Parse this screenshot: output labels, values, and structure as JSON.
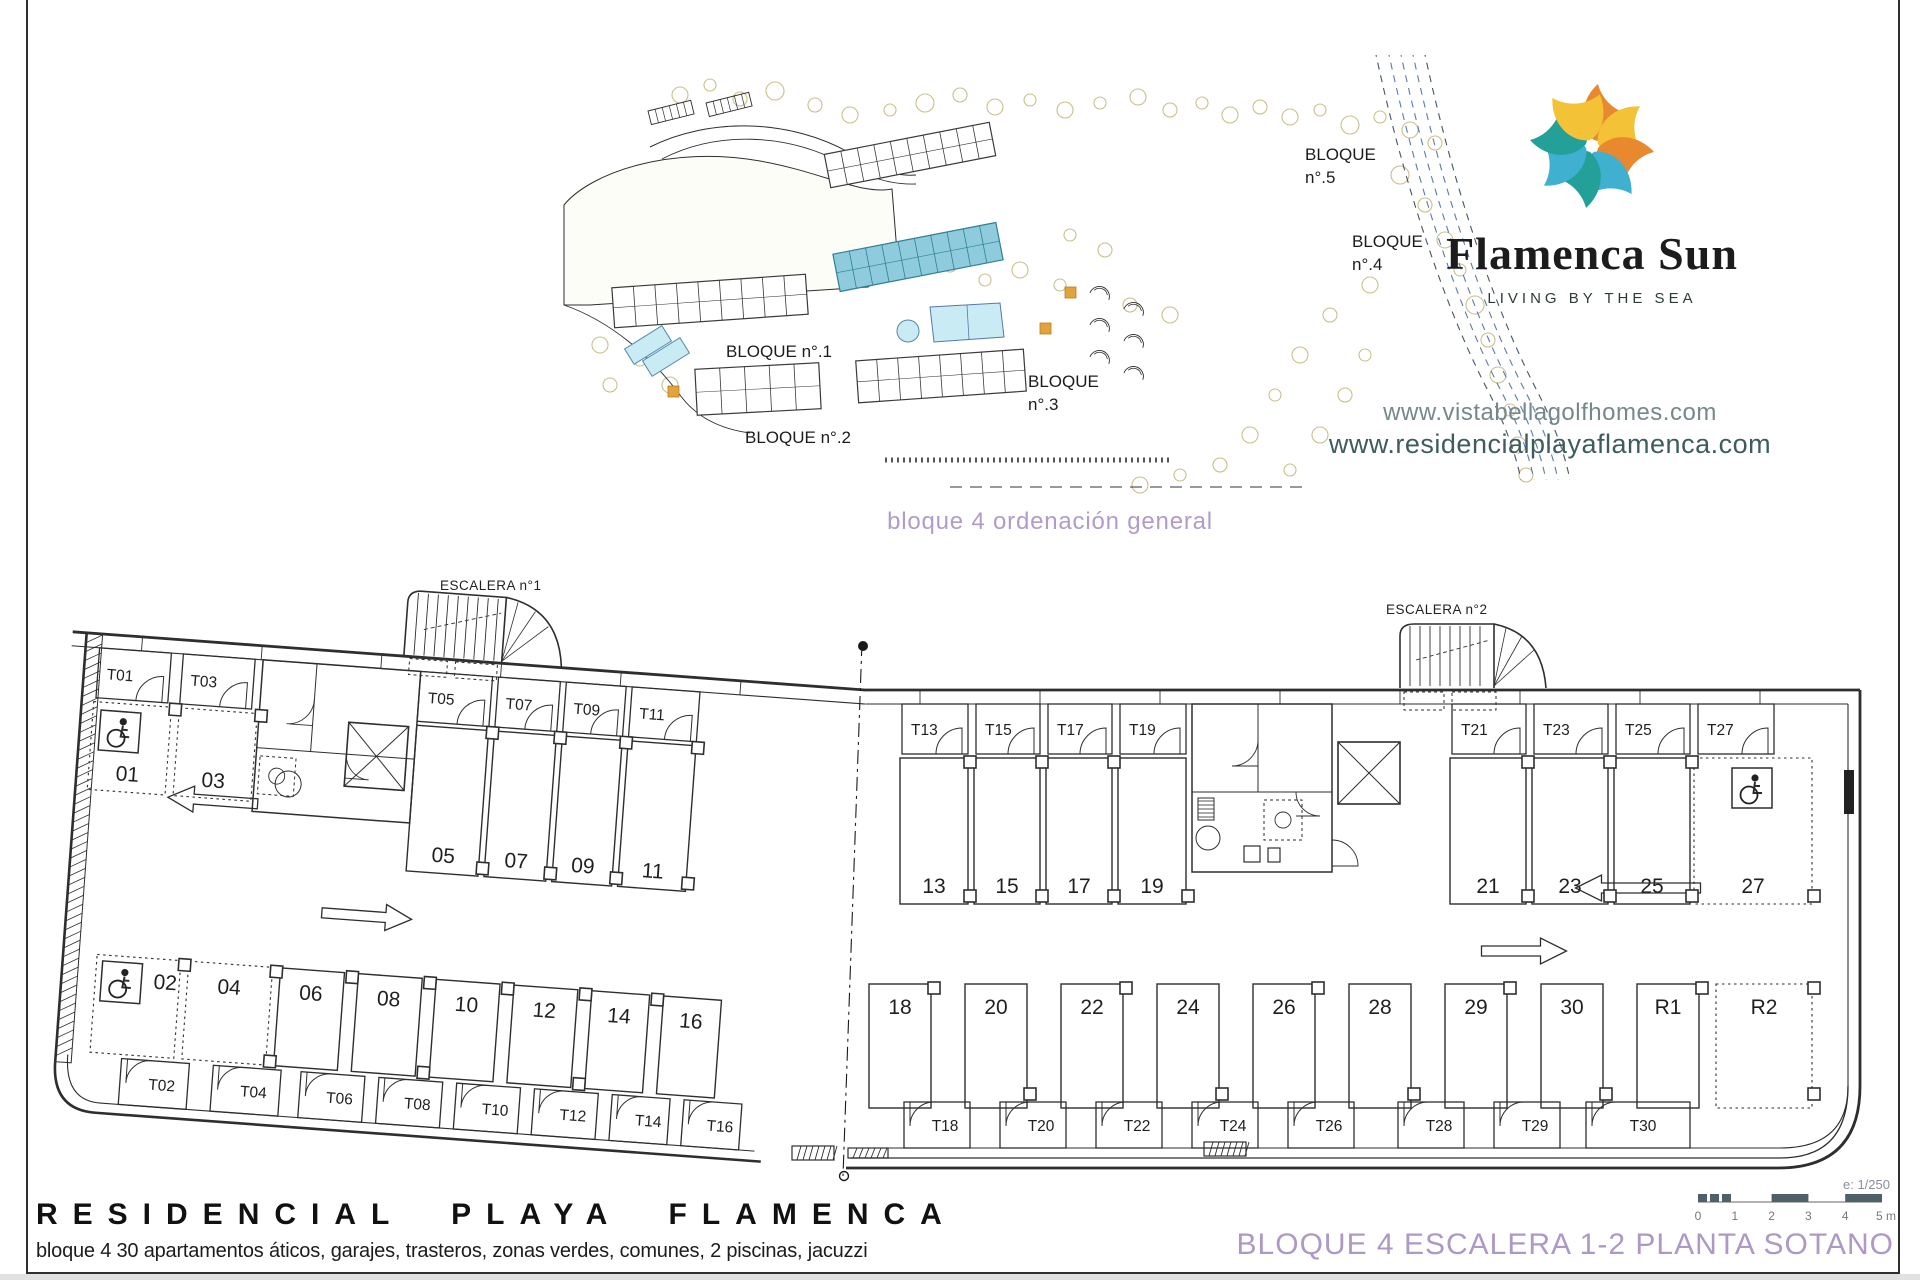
{
  "brand": {
    "name": "Flamenca Sun",
    "tagline": "LIVING BY THE SEA",
    "urls": [
      "www.vistabellagolfhomes.com",
      "www.residencialplayaflamenca.com"
    ],
    "logo_petal_colors": [
      "#e8882f",
      "#f3c237",
      "#e8882f",
      "#3fb0cf",
      "#23a097",
      "#3fb0cf",
      "#23a097",
      "#f3c237"
    ]
  },
  "site_plan": {
    "caption": "bloque 4 ordenación general",
    "block_labels": {
      "b5": [
        "BLOQUE",
        "n°.5"
      ],
      "b4": [
        "BLOQUE",
        "n°.4"
      ],
      "b1": [
        "BLOQUE n°.1"
      ],
      "b2": [
        "BLOQUE n°.2"
      ],
      "b3": [
        "BLOQUE",
        "n°.3"
      ]
    },
    "highlight_color": "#8ecbdc",
    "pool_color": "#c9ecf4",
    "tree_color": "#c9c08a"
  },
  "floor_plan": {
    "escalera1": "ESCALERA n°1",
    "escalera2": "ESCALERA n°2",
    "left_wing": {
      "top_parking": [
        "01",
        "03",
        "05",
        "07",
        "09",
        "11"
      ],
      "top_storage": [
        "T01",
        "T03",
        "T05",
        "T07",
        "T09",
        "T11"
      ],
      "bottom_parking": [
        "02",
        "04",
        "06",
        "08",
        "10",
        "12",
        "14",
        "16"
      ],
      "bottom_storage": [
        "T02",
        "T04",
        "T06",
        "T08",
        "T10",
        "T12",
        "T14",
        "T16"
      ]
    },
    "right_wing": {
      "top_parking": [
        "13",
        "15",
        "17",
        "19",
        "21",
        "23",
        "25",
        "27"
      ],
      "top_storage": [
        "T13",
        "T15",
        "T17",
        "T19",
        "T21",
        "T23",
        "T25",
        "T27"
      ],
      "bottom_parking": [
        "18",
        "20",
        "22",
        "24",
        "26",
        "28",
        "29",
        "30",
        "R1",
        "R2"
      ],
      "bottom_storage": [
        "T18",
        "T20",
        "T22",
        "T24",
        "T26",
        "T28",
        "T29",
        "T30"
      ]
    }
  },
  "footer": {
    "project_title": "RESIDENCIAL PLAYA FLAMENCA",
    "project_subtitle": "bloque 4 30 apartamentos áticos, garajes, trasteros, zonas verdes, comunes, 2 piscinas, jacuzzi",
    "sheet_title": "BLOQUE 4 ESCALERA 1-2 PLANTA SOTANO",
    "scale_note": "e: 1/250",
    "scale_ticks": [
      "0",
      "1",
      "2",
      "3",
      "4",
      "5 m"
    ]
  }
}
